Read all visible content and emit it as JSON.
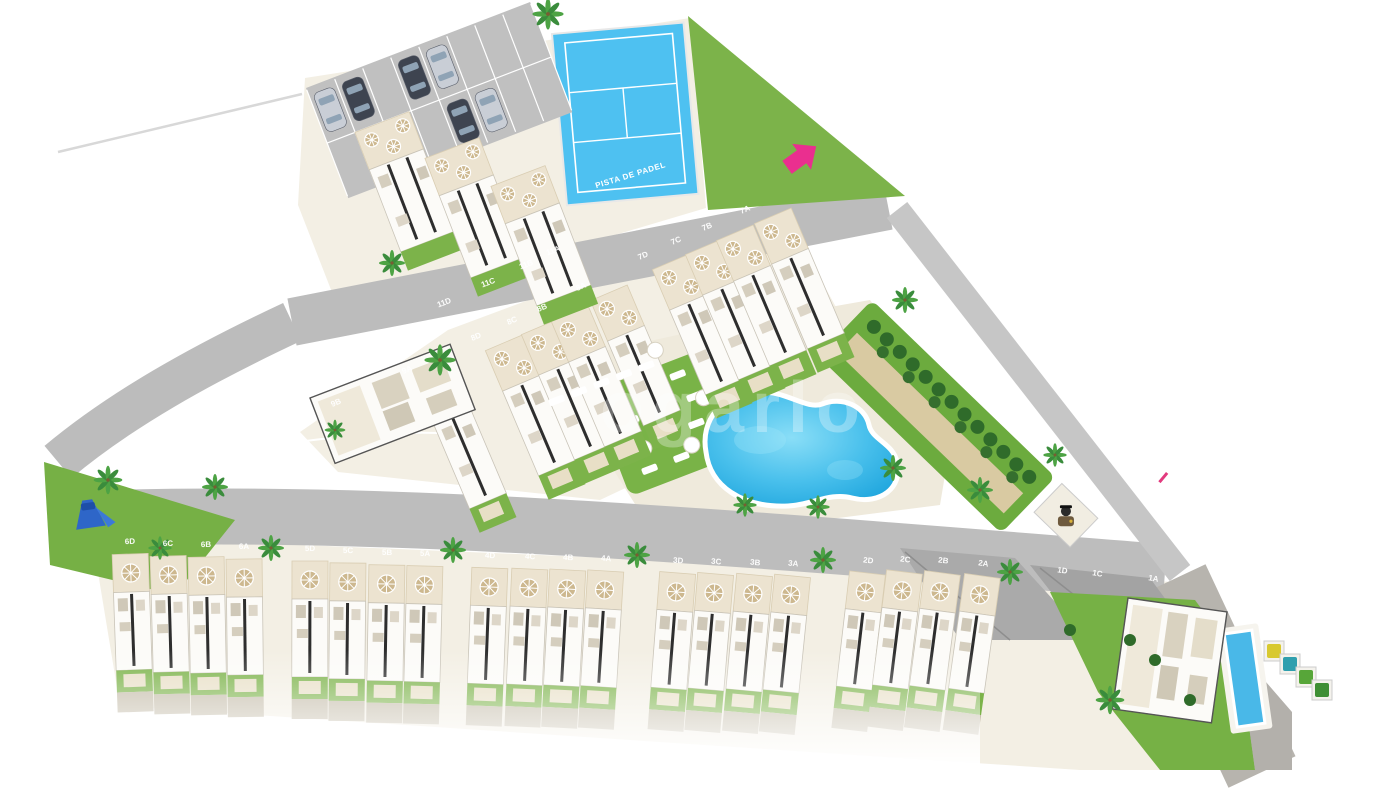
{
  "scene": {
    "padel_court_label": "PISTA DE PADEL",
    "watermark_text": "ogarlo"
  },
  "units": {
    "top_row": [
      "11D",
      "11C",
      "11B",
      "11A"
    ],
    "middle_row": [
      "9B",
      "9A",
      "8D",
      "8C",
      "8B",
      "8A",
      "7D",
      "7C",
      "7B",
      "7A"
    ],
    "bottom_row": [
      "6D",
      "6C",
      "6B",
      "6A",
      "5D",
      "5C",
      "5B",
      "5A",
      "4D",
      "4C",
      "4B",
      "4A",
      "3D",
      "3C",
      "3B",
      "3A",
      "2D",
      "2C",
      "2B",
      "2A",
      "1D",
      "1C",
      "1A"
    ]
  },
  "amenities": [
    "padel-court",
    "communal-pool",
    "sunbathing-lawn",
    "orchard-garden",
    "children-playground",
    "parking",
    "guard-post",
    "lap-pool",
    "recycling-bins",
    "entrance-arrow"
  ],
  "colors": {
    "pool_blue": "#35b5e9",
    "pool_blue_light": "#8adef7",
    "court_blue": "#4ec1f1",
    "grass_green": "#7cb34a",
    "hedge_green": "#2f6b2a",
    "road_gray": "#bcbcbc",
    "ground_beige": "#f3efe4",
    "terrace_beige": "#ece3d0",
    "house_white": "#fcfbf8",
    "accent_pink": "#ea2f8f",
    "car_dark": "#3e4450",
    "car_silver": "#c9ced6",
    "bin_colors": [
      "#d8c92f",
      "#2f9fae",
      "#57a639",
      "#3f8f34"
    ]
  }
}
